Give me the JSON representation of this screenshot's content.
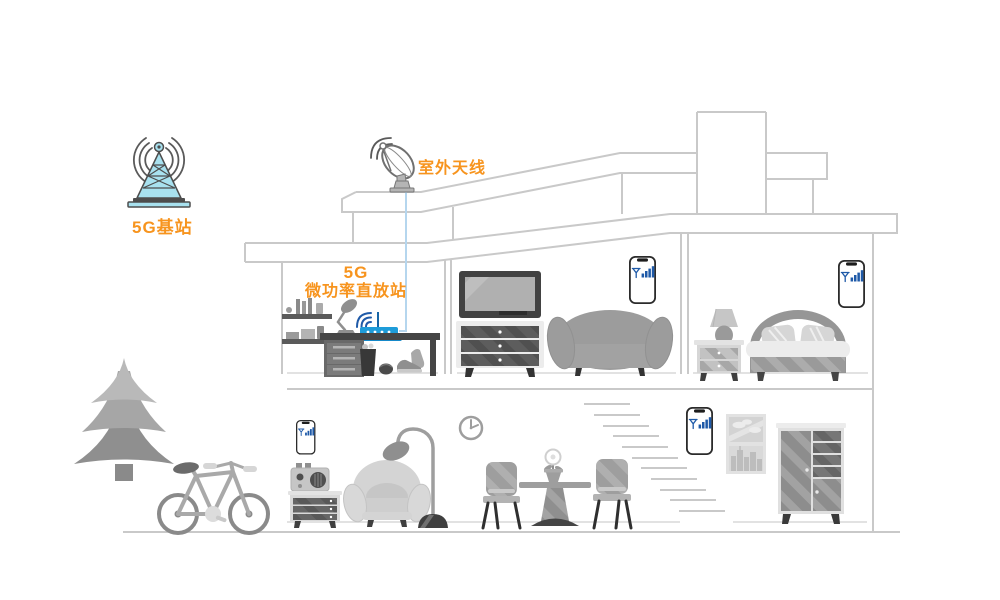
{
  "diagram": {
    "base_station": {
      "label": "5G基站",
      "icon": "cell-tower-icon"
    },
    "outdoor_antenna": {
      "label": "室外天线",
      "icon": "satellite-dish-icon"
    },
    "repeater": {
      "label_line1": "5G",
      "label_line2": "微功率直放站",
      "icon": "wifi-router-icon"
    },
    "phones": {
      "count": 4,
      "icon": "phone-signal-icon",
      "signal_bars": 4
    },
    "colors": {
      "accent_orange": "#F7941E",
      "signal_blue": "#1F5AA8",
      "router_blue": "#1E9CD9",
      "tower_cyan": "#A8E1EF",
      "cable_blue": "#B5D6EE",
      "outline_gray": "#C9C9C9"
    }
  }
}
